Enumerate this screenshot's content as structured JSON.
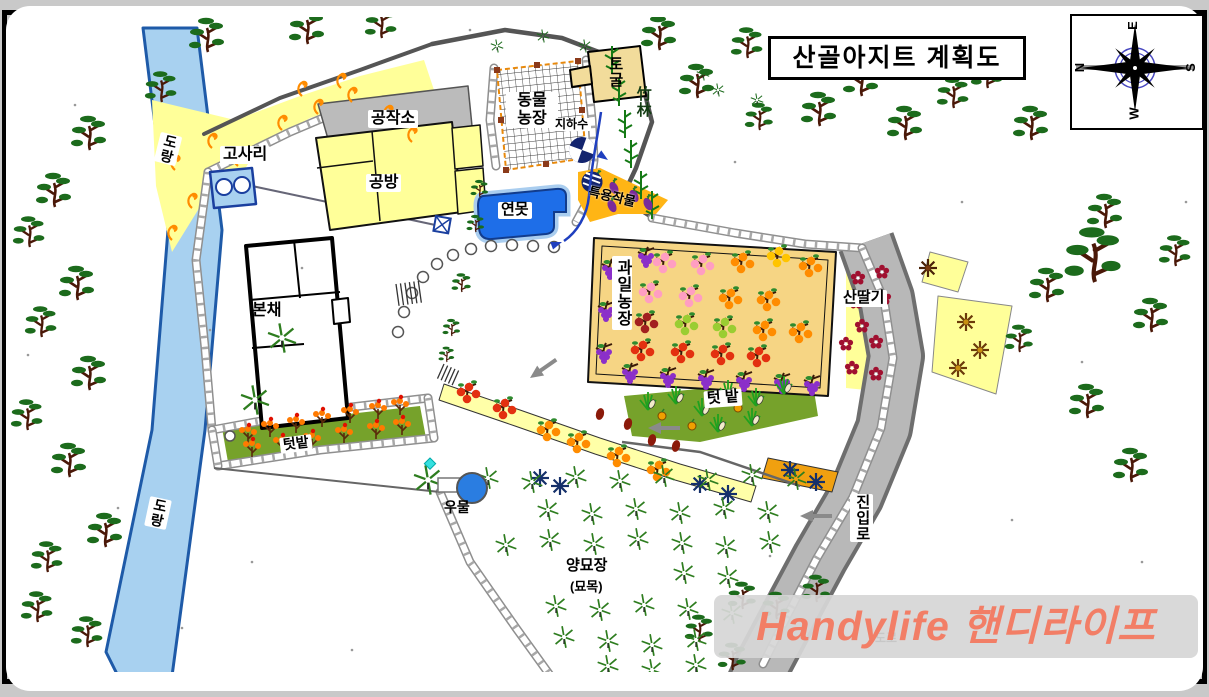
{
  "title": "산골아지트 계획도",
  "watermark": "Handylife 핸디라이프",
  "compass": {
    "top": "E",
    "bottom": "W",
    "left": "N",
    "right": "S"
  },
  "labels": {
    "stream_top": "도랑",
    "stream_bottom": "도랑",
    "fern": "고사리",
    "workshop": "공작소",
    "craft_room": "공방",
    "main_house": "본채",
    "animal_farm_line1": "동물",
    "animal_farm_line2": "농장",
    "cave": "토굴",
    "bamboo_forest": "竹林",
    "groundwater": "지하수",
    "pond": "연못",
    "special_crops": "특용작물",
    "fruit_farm": "과일농장",
    "wild_raspberry": "산딸기",
    "veg_garden_right": "텃 밭",
    "veg_garden_left": "텃밭",
    "well": "우물",
    "nursery_line1": "양묘장",
    "nursery_line2": "(묘목)",
    "access_road": "진입로",
    "road": "도로"
  },
  "colors": {
    "stream": "#A8D1F0",
    "stream_border": "#1E5AA8",
    "area_yellow": "#FFFF99",
    "orchard": "#F6D584",
    "special_crops": "#FFB515",
    "vegetable_green": "#76A22B",
    "road": "#B8B8B8",
    "road_edge": "#6E6E6E",
    "pond": "#1E6EE8",
    "pond_rim": "#A9CDEF",
    "building_yellow": "#FFFF99",
    "workshop_gray": "#BBBBBB",
    "cave_tan": "#F2DC9B",
    "pine_green": "#1C6B1C",
    "trunk_brown": "#4A1808",
    "navy": "#13246E",
    "pipe_blue": "#1F3FBF",
    "fence_orange": "#E8890C",
    "arrow_gray": "#8A8A8A",
    "watermark_text": "#F27E66",
    "wall_gray": "#8F8F8F"
  },
  "icons": {
    "compass_rose": "8-point star",
    "pine_tree": "pine glyph",
    "seedling": "radial asterisk",
    "fern": "orange curl",
    "corn": "corn stalk",
    "pepper": "pepper plant",
    "fruit_tree": "trunk with fruit circles",
    "grape": "grape cluster",
    "raspberry_flower": "5-petal flower",
    "chestnut_flower": "8-point brown star",
    "eggplant": "purple eggplant",
    "well": "blue circle",
    "groundwater_benchmark": "quadrant circle",
    "direction_arrow": "gray left arrow",
    "stepping_stones": "circle chain",
    "bamboo": "bamboo stalk"
  }
}
